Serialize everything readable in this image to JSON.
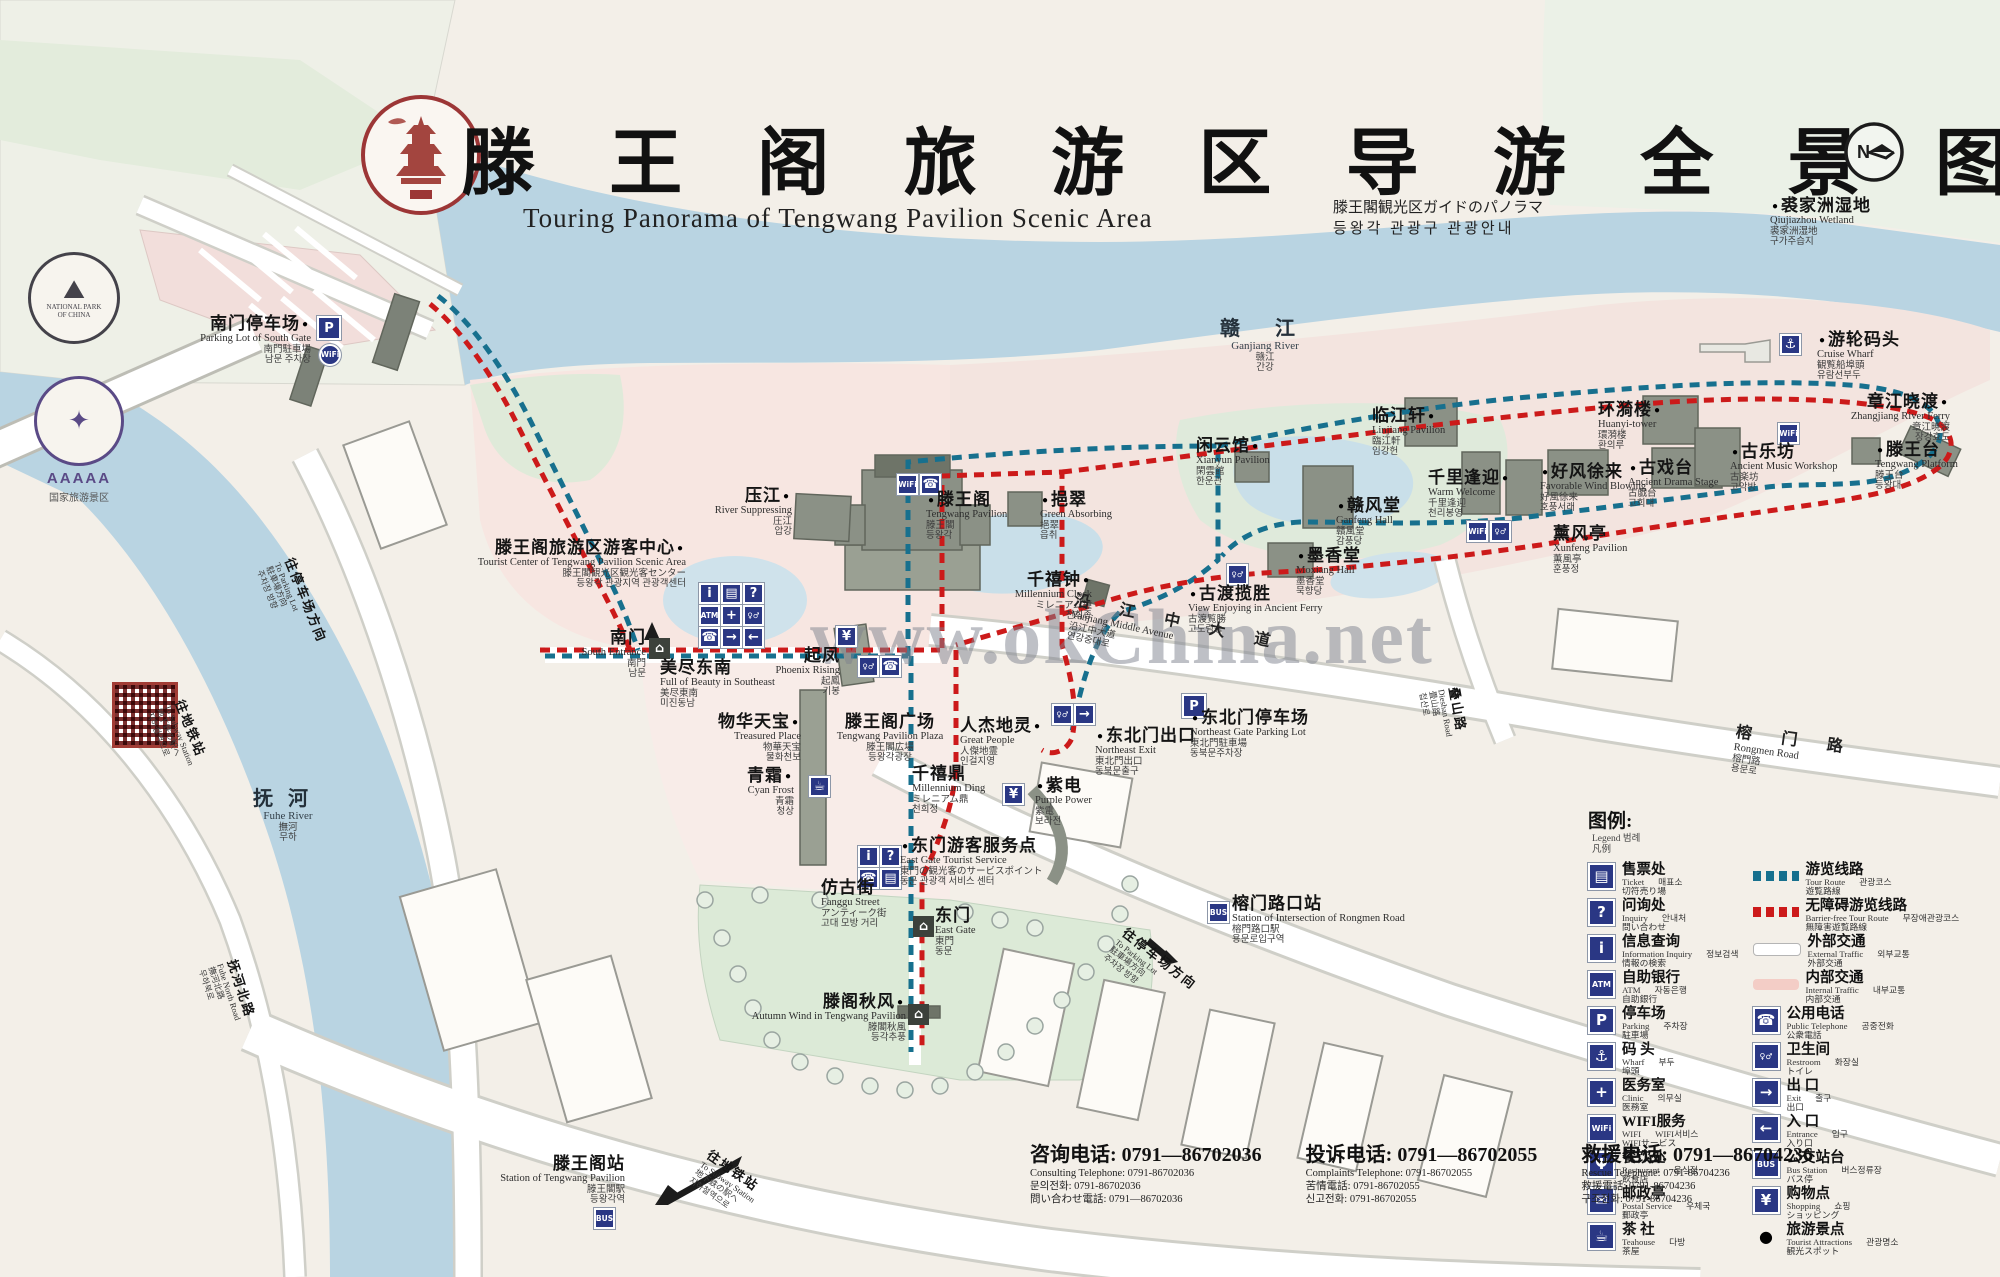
{
  "header": {
    "title": "滕 王 阁 旅 游 区 导 游 全 景 图",
    "subtitle_en": "Touring Panorama of Tengwang Pavilion Scenic Area",
    "subtitle_ja": "滕王閣観光区ガイドのパノラマ",
    "subtitle_ko": "등왕각 관광구 관광안내",
    "compass": "N",
    "seal_name": "tengwang-pavilion-seal"
  },
  "badges": {
    "national_park_line1": "NATIONAL PARK",
    "national_park_line2": "OF CHINA",
    "aaaaa": "AAAAA",
    "aaaaa_sub": "国家旅游景区"
  },
  "watermark": "www.okChina.net",
  "colors": {
    "tour_route": "#17708e",
    "barrier_free_route": "#cc1a1a",
    "icon_blue": "#2a3784",
    "water": "#b9d4e2",
    "park_green": "#dcead7",
    "garden_pink": "#f6e3de"
  },
  "map": {
    "labels": [
      {
        "id": "qiujiazhou-wetland",
        "zh": "裘家洲湿地",
        "en": "Qiujiazhou Wetland",
        "ja": "裘家洲湿地",
        "ko": "구가주습지",
        "x": 1770,
        "y": 196,
        "align": "l",
        "dot": "l"
      },
      {
        "id": "ganjiang-river",
        "zh": "赣 江",
        "en": "Ganjiang River",
        "ja": "赣江",
        "ko": "간강",
        "x": 1265,
        "y": 318,
        "align": "c",
        "cls": "river"
      },
      {
        "id": "cruise-wharf",
        "zh": "游轮码头",
        "en": "Cruise Wharf",
        "ja": "観覧船埠頭",
        "ko": "유람선부두",
        "x": 1817,
        "y": 330,
        "align": "l",
        "dot": "l"
      },
      {
        "id": "zhangjiang-river-ferry",
        "zh": "章江晓渡",
        "en": "Zhangjiang River Ferry",
        "ja": "章江暁渡",
        "ko": "장강효도",
        "x": 1950,
        "y": 392,
        "align": "r",
        "dot": "r"
      },
      {
        "id": "tengwang-platform",
        "zh": "滕王台",
        "en": "Tengwang Platform",
        "ja": "滕王台",
        "ko": "등왕대",
        "x": 1875,
        "y": 440,
        "align": "l",
        "dot": "l"
      },
      {
        "id": "huanyi-tower",
        "zh": "环漪楼",
        "en": "Huanyi-tower",
        "ja": "環漪楼",
        "ko": "환의루",
        "x": 1598,
        "y": 400,
        "align": "l",
        "dot": "r"
      },
      {
        "id": "ancient-music-workshop",
        "zh": "古乐坊",
        "en": "Ancient Music Workshop",
        "ja": "古楽坊",
        "ko": "고악방",
        "x": 1730,
        "y": 442,
        "align": "l",
        "dot": "l"
      },
      {
        "id": "ancient-drama-stage",
        "zh": "古戏台",
        "en": "Ancient Drama Stage",
        "ja": "古戯台",
        "ko": "고희대",
        "x": 1628,
        "y": 458,
        "align": "l",
        "dot": "l"
      },
      {
        "id": "xunfeng-pavilion",
        "zh": "薰风亭",
        "en": "Xunfeng Pavilion",
        "ja": "薫風亭",
        "ko": "훈풍정",
        "x": 1553,
        "y": 524,
        "align": "l"
      },
      {
        "id": "favorable-wind-blowing",
        "zh": "好风徐来",
        "en": "Favorable Wind Blowing",
        "ja": "好風徐来",
        "ko": "호풍서래",
        "x": 1540,
        "y": 462,
        "align": "l",
        "dot": "l"
      },
      {
        "id": "warm-welcome",
        "zh": "千里逢迎",
        "en": "Warm Welcome",
        "ja": "千里逢迎",
        "ko": "천리봉영",
        "x": 1428,
        "y": 468,
        "align": "l",
        "dot": "r"
      },
      {
        "id": "linjiang-pavilion",
        "zh": "临江轩",
        "en": "Linjiang Pavilion",
        "ja": "臨江軒",
        "ko": "임강헌",
        "x": 1372,
        "y": 406,
        "align": "l",
        "dot": "r"
      },
      {
        "id": "ganfeng-hall",
        "zh": "赣风堂",
        "en": "Ganfeng Hall",
        "ja": "贛風堂",
        "ko": "감풍당",
        "x": 1336,
        "y": 496,
        "align": "l",
        "dot": "l"
      },
      {
        "id": "moxiang-hall",
        "zh": "墨香堂",
        "en": "Moxiang Hall",
        "ja": "墨香堂",
        "ko": "묵향당",
        "x": 1296,
        "y": 546,
        "align": "l",
        "dot": "l"
      },
      {
        "id": "xianyun-pavilion",
        "zh": "闲云馆",
        "en": "Xianyun Pavilion",
        "ja": "閑雲館",
        "ko": "한운관",
        "x": 1196,
        "y": 436,
        "align": "l",
        "dot": "r"
      },
      {
        "id": "ancient-ferry-view",
        "zh": "古渡揽胜",
        "en": "View Enjoying in Ancient Ferry",
        "ja": "古渡覧勝",
        "ko": "고도람승",
        "x": 1188,
        "y": 584,
        "align": "l",
        "dot": "l"
      },
      {
        "id": "millennium-clock",
        "zh": "千禧钟",
        "en": "Millennium Clock",
        "ja": "ミレニアム鐘",
        "ko": "천희종",
        "x": 1092,
        "y": 570,
        "align": "r",
        "dot": "r"
      },
      {
        "id": "green-absorbing",
        "zh": "挹翠",
        "en": "Green Absorbing",
        "ja": "挹翠",
        "ko": "읍취",
        "x": 1040,
        "y": 490,
        "align": "l",
        "dot": "l"
      },
      {
        "id": "tengwang-pavilion",
        "zh": "滕王阁",
        "en": "Tengwang Pavilion",
        "ja": "滕王閣",
        "ko": "등왕각",
        "x": 926,
        "y": 490,
        "align": "l",
        "dot": "l"
      },
      {
        "id": "river-suppressing",
        "zh": "压江",
        "en": "River Suppressing",
        "ja": "圧江",
        "ko": "압강",
        "x": 792,
        "y": 486,
        "align": "r",
        "dot": "r"
      },
      {
        "id": "visitor-center",
        "zh": "滕王阁旅游区游客中心",
        "en": "Tourist Center of Tengwang Pavilion Scenic Area",
        "ja": "滕王閣観光区観光客センター",
        "ko": "등왕각 관광지역 관광객센터",
        "x": 686,
        "y": 538,
        "align": "r",
        "dot": "r"
      },
      {
        "id": "south-gate-parking",
        "zh": "南门停车场",
        "en": "Parking Lot of South Gate",
        "ja": "南門駐車場",
        "ko": "남문 주차장",
        "x": 311,
        "y": 314,
        "align": "r",
        "dot": "r"
      },
      {
        "id": "south-entrance",
        "zh": "南门",
        "en": "South Entrance",
        "ja": "南門",
        "ko": "남문",
        "x": 646,
        "y": 628,
        "align": "r"
      },
      {
        "id": "beauty-in-southeast",
        "zh": "美尽东南",
        "en": "Full of Beauty in Southeast",
        "ja": "美尽東南",
        "ko": "미진동남",
        "x": 660,
        "y": 658,
        "align": "l"
      },
      {
        "id": "phoenix-rising",
        "zh": "起凤",
        "en": "Phoenix Rising",
        "ja": "起鳳",
        "ko": "기봉",
        "x": 840,
        "y": 646,
        "align": "r"
      },
      {
        "id": "treasured-place",
        "zh": "物华天宝",
        "en": "Treasured Place",
        "ja": "物華天宝",
        "ko": "물화천보",
        "x": 801,
        "y": 712,
        "align": "r",
        "dot": "r"
      },
      {
        "id": "tengwang-pavilion-plaza",
        "zh": "滕王阁广场",
        "en": "Tengwang Pavilion Plaza",
        "ja": "滕王閣広場",
        "ko": "등왕각광장",
        "x": 890,
        "y": 712,
        "align": "c"
      },
      {
        "id": "cyan-frost",
        "zh": "青霜",
        "en": "Cyan Frost",
        "ja": "青霜",
        "ko": "청상",
        "x": 794,
        "y": 766,
        "align": "r",
        "dot": "r"
      },
      {
        "id": "millennium-ding",
        "zh": "千禧鼎",
        "en": "Millennium Ding",
        "ja": "ミレニアム鼎",
        "ko": "천희정",
        "x": 912,
        "y": 764,
        "align": "l"
      },
      {
        "id": "great-people",
        "zh": "人杰地灵",
        "en": "Great People",
        "ja": "人傑地霊",
        "ko": "인걸지영",
        "x": 960,
        "y": 716,
        "align": "l",
        "dot": "r"
      },
      {
        "id": "northeast-exit",
        "zh": "东北门出口",
        "en": "Northeast Exit",
        "ja": "東北門出口",
        "ko": "동북문출구",
        "x": 1095,
        "y": 726,
        "align": "l",
        "dot": "l"
      },
      {
        "id": "northeast-gate-parking",
        "zh": "东北门停车场",
        "en": "Northeast Gate Parking Lot",
        "ja": "東北門駐車場",
        "ko": "동북문주차장",
        "x": 1190,
        "y": 708,
        "align": "l",
        "dot": "l"
      },
      {
        "id": "purple-power",
        "zh": "紫电",
        "en": "Purple Power",
        "ja": "紫電",
        "ko": "보라전",
        "x": 1035,
        "y": 776,
        "align": "l",
        "dot": "l"
      },
      {
        "id": "east-gate-tourist-service",
        "zh": "东门游客服务点",
        "en": "East Gate Tourist Service",
        "ja": "東門の観光客のサービスポイント",
        "ko": "동문 관광객 서비스 센터",
        "x": 900,
        "y": 836,
        "align": "l",
        "dot": "l"
      },
      {
        "id": "fanggu-street",
        "zh": "仿古街",
        "en": "Fanggu Street",
        "ja": "アンティーク街",
        "ko": "고대 모방 거리",
        "x": 821,
        "y": 878,
        "align": "l"
      },
      {
        "id": "east-gate",
        "zh": "东门",
        "en": "East Gate",
        "ja": "東門",
        "ko": "동문",
        "x": 935,
        "y": 906,
        "align": "l"
      },
      {
        "id": "autumn-wind",
        "zh": "滕阁秋风",
        "en": "Autumn Wind in Tengwang Pavilion",
        "ja": "滕閣秋風",
        "ko": "등각추풍",
        "x": 906,
        "y": 992,
        "align": "r",
        "dot": "r"
      },
      {
        "id": "to-parking-right",
        "zh": "往停车场方向",
        "en": "To Parking Lot",
        "ja": "駐車場方向",
        "ko": "주차장 방향",
        "x": 1128,
        "y": 926,
        "align": "l",
        "rot": 38,
        "cls": "small"
      },
      {
        "id": "rongmen-crossing-station",
        "zh": "榕门路口站",
        "en": "Station of Intersection of Rongmen Road",
        "ja": "榕門路口駅",
        "ko": "용문로입구역",
        "x": 1232,
        "y": 894,
        "align": "l"
      },
      {
        "id": "tengwang-pavilion-station",
        "zh": "滕王阁站",
        "en": "Station of Tengwang Pavilion",
        "ja": "滕王閣駅",
        "ko": "등왕각역",
        "x": 625,
        "y": 1154,
        "align": "r"
      },
      {
        "id": "to-subway-bottom",
        "zh": "往地铁站",
        "en": "To Subway Station",
        "ja": "地下鉄の駅へ",
        "ko": "지하철역으로",
        "x": 712,
        "y": 1148,
        "align": "l",
        "rot": 35,
        "cls": "small"
      },
      {
        "id": "to-subway-left",
        "zh": "往地铁站",
        "en": "To Subway Station",
        "ja": "地下鉄の駅へ",
        "ko": "지하철역으로",
        "x": 185,
        "y": 698,
        "align": "l",
        "rot": 68,
        "cls": "small"
      },
      {
        "id": "to-parking-left",
        "zh": "往停车场方向",
        "en": "To Parking Lot",
        "ja": "駐車場方向",
        "ko": "주차장 방향",
        "x": 295,
        "y": 556,
        "align": "l",
        "rot": 68,
        "cls": "small"
      },
      {
        "id": "fuhe-river",
        "zh": "抚河",
        "en": "Fuhe River",
        "ja": "撫河",
        "ko": "무하",
        "x": 288,
        "y": 788,
        "align": "c",
        "cls": "river"
      },
      {
        "id": "fuhe-north-road",
        "zh": "抚河北路",
        "en": "Fuhe North Road",
        "ja": "撫河北路",
        "ko": "무하북로",
        "x": 238,
        "y": 958,
        "align": "l",
        "rot": 72,
        "cls": "small"
      },
      {
        "id": "dieshan-road",
        "zh": "叠山路",
        "en": "Dieshan Road",
        "ja": "畳山路",
        "ko": "첩산로",
        "x": 1460,
        "y": 686,
        "align": "l",
        "rot": 80,
        "cls": "small"
      },
      {
        "id": "rongmen-road",
        "zh": "榕 门 路",
        "en": "Rongmen Road",
        "ja": "榕門路",
        "ko": "용문로",
        "x": 1737,
        "y": 724,
        "align": "l",
        "rot": 8,
        "cls": "roadname"
      },
      {
        "id": "yanjiang-middle-avenue",
        "zh": "沿 江 中 大 道",
        "en": "Yanjiang Middle Avenue",
        "ja": "沿江中大道",
        "ko": "연강중대로",
        "x": 1076,
        "y": 592,
        "align": "l",
        "rot": 12,
        "cls": "roadname"
      }
    ],
    "icons": [
      {
        "n": "parking-icon",
        "g": "P",
        "x": 317,
        "y": 316,
        "s": 24
      },
      {
        "n": "wifi-icon",
        "g": "WiFi",
        "x": 319,
        "y": 344,
        "s": 22,
        "c": "circle tiny"
      },
      {
        "n": "info-icon",
        "g": "i",
        "x": 699,
        "y": 583
      },
      {
        "n": "ticket-icon",
        "g": "▤",
        "x": 721,
        "y": 583
      },
      {
        "n": "inquiry-icon",
        "g": "?",
        "x": 743,
        "y": 583
      },
      {
        "n": "atm-icon",
        "g": "ATM",
        "x": 699,
        "y": 605,
        "c": "tiny"
      },
      {
        "n": "clinic-icon",
        "g": "+",
        "x": 721,
        "y": 605
      },
      {
        "n": "restroom-icon",
        "g": "♀♂",
        "x": 743,
        "y": 605,
        "c": "tiny"
      },
      {
        "n": "phone-icon",
        "g": "☎",
        "x": 699,
        "y": 627
      },
      {
        "n": "exit-icon",
        "g": "→",
        "x": 721,
        "y": 627
      },
      {
        "n": "entrance-icon",
        "g": "←",
        "x": 743,
        "y": 627
      },
      {
        "n": "wifi-icon",
        "g": "WiFi",
        "x": 897,
        "y": 474,
        "c": "tiny"
      },
      {
        "n": "phone-icon",
        "g": "☎",
        "x": 920,
        "y": 474
      },
      {
        "n": "restroom-icon",
        "g": "♀♂",
        "x": 1227,
        "y": 564,
        "c": "tiny"
      },
      {
        "n": "wifi-icon",
        "g": "WiFi",
        "x": 1467,
        "y": 521,
        "c": "tiny"
      },
      {
        "n": "restroom-icon",
        "g": "♀♂",
        "x": 1490,
        "y": 521,
        "c": "tiny"
      },
      {
        "n": "wifi-icon",
        "g": "WiFi",
        "x": 1778,
        "y": 423,
        "c": "tiny"
      },
      {
        "n": "wharf-icon",
        "g": "⚓",
        "x": 1780,
        "y": 334
      },
      {
        "n": "restroom-icon",
        "g": "♀♂",
        "x": 1052,
        "y": 704,
        "c": "tiny"
      },
      {
        "n": "exit-icon",
        "g": "→",
        "x": 1074,
        "y": 704
      },
      {
        "n": "parking-icon",
        "g": "P",
        "x": 1182,
        "y": 694,
        "s": 24
      },
      {
        "n": "shopping-icon",
        "g": "¥",
        "x": 1003,
        "y": 784
      },
      {
        "n": "teahouse-icon",
        "g": "☕",
        "x": 809,
        "y": 776
      },
      {
        "n": "info-icon",
        "g": "i",
        "x": 858,
        "y": 846
      },
      {
        "n": "inquiry-icon",
        "g": "?",
        "x": 880,
        "y": 846
      },
      {
        "n": "phone-icon",
        "g": "☎",
        "x": 858,
        "y": 868
      },
      {
        "n": "ticket-icon",
        "g": "▤",
        "x": 880,
        "y": 868
      },
      {
        "n": "shopping-icon",
        "g": "¥",
        "x": 836,
        "y": 626
      },
      {
        "n": "restroom-icon",
        "g": "♀♂",
        "x": 858,
        "y": 656,
        "c": "tiny"
      },
      {
        "n": "phone-icon",
        "g": "☎",
        "x": 880,
        "y": 656
      },
      {
        "n": "bus-stop-icon",
        "g": "BUS",
        "x": 1208,
        "y": 902,
        "c": "tiny"
      },
      {
        "n": "bus-stop-icon",
        "g": "BUS",
        "x": 594,
        "y": 1208,
        "c": "tiny"
      },
      {
        "n": "south-gate-icon",
        "g": "⌂",
        "x": 649,
        "y": 638,
        "c": "dark"
      },
      {
        "n": "east-gate-icon",
        "g": "⌂",
        "x": 913,
        "y": 916,
        "c": "dark"
      },
      {
        "n": "pavilion-marker-icon",
        "g": "⌂",
        "x": 908,
        "y": 1004,
        "c": "dark"
      }
    ]
  },
  "legend": {
    "title_zh": "图例:",
    "title_en": "Legend",
    "title_ko": "범례",
    "title_ja": "凡例",
    "left": [
      {
        "icon": "ticket-icon",
        "g": "▤",
        "zh": "售票处",
        "en": "Ticket",
        "ko": "매표소",
        "ja": "切符売り場"
      },
      {
        "icon": "inquiry-icon",
        "g": "?",
        "zh": "问询处",
        "en": "Inquiry",
        "ko": "안내처",
        "ja": "問い合わせ"
      },
      {
        "icon": "information-icon",
        "g": "i",
        "zh": "信息查询",
        "en": "Information Inquiry",
        "ko": "정보검색",
        "ja": "情報の検索"
      },
      {
        "icon": "atm-icon",
        "g": "ATM",
        "tiny": true,
        "zh": "自助银行",
        "en": "ATM",
        "ko": "자동은행",
        "ja": "自助銀行"
      },
      {
        "icon": "parking-icon",
        "g": "P",
        "zh": "停车场",
        "en": "Parking",
        "ko": "주차장",
        "ja": "駐車場"
      },
      {
        "icon": "wharf-icon",
        "g": "⚓",
        "zh": "码 头",
        "en": "Wharf",
        "ko": "부두",
        "ja": "埠頭"
      },
      {
        "icon": "clinic-icon",
        "g": "+",
        "zh": "医务室",
        "en": "Clinic",
        "ko": "의무실",
        "ja": "医務室"
      },
      {
        "icon": "wifi-icon",
        "g": "WiFi",
        "tiny": true,
        "zh": "WIFI服务",
        "en": "WIFI",
        "ko": "WIFI서비스",
        "ja": "WIFIサービス"
      },
      {
        "icon": "restaurant-icon",
        "g": "Ψ",
        "zh": "餐饮处",
        "en": "Restaurant",
        "ko": "음식점",
        "ja": "飲食店"
      },
      {
        "icon": "postal-icon",
        "g": "✉",
        "zh": "邮政亭",
        "en": "Postal Service",
        "ko": "우체국",
        "ja": "郵政亭"
      },
      {
        "icon": "teahouse-icon",
        "g": "☕",
        "zh": "茶 社",
        "en": "Teahouse",
        "ko": "다방",
        "ja": "茶屋"
      }
    ],
    "right": [
      {
        "sw": "sw-blue",
        "zh": "游览线路",
        "en": "Tour Route",
        "ko": "관광코스",
        "ja": "遊覧路線"
      },
      {
        "sw": "sw-red",
        "zh": "无障碍游览线路",
        "en": "Barrier-free Tour Route",
        "ko": "무장애관광코스",
        "ja": "無障害遊覧路線"
      },
      {
        "sw": "sw-white",
        "zh": "外部交通",
        "en": "External Traffic",
        "ko": "외부교통",
        "ja": "外部交通"
      },
      {
        "sw": "sw-pink",
        "zh": "内部交通",
        "en": "Internal Traffic",
        "ko": "내부교통",
        "ja": "内部交通"
      },
      {
        "icon": "telephone-icon",
        "g": "☎",
        "zh": "公用电话",
        "en": "Public Telephone",
        "ko": "공중전화",
        "ja": "公衆電話"
      },
      {
        "icon": "restroom-icon",
        "g": "♀♂",
        "tiny": true,
        "zh": "卫生间",
        "en": "Restroom",
        "ko": "화장실",
        "ja": "トイレ"
      },
      {
        "icon": "exit-icon",
        "g": "→",
        "zh": "出 口",
        "en": "Exit",
        "ko": "출구",
        "ja": "出口"
      },
      {
        "icon": "entrance-icon",
        "g": "←",
        "zh": "入 口",
        "en": "Entrance",
        "ko": "입구",
        "ja": "入り口"
      },
      {
        "icon": "bus-icon",
        "g": "BUS",
        "tiny": true,
        "zh": "公交站台",
        "en": "Bus Station",
        "ko": "버스정류장",
        "ja": "バス停"
      },
      {
        "icon": "shopping-icon",
        "g": "¥",
        "zh": "购物点",
        "en": "Shopping",
        "ko": "쇼핑",
        "ja": "ショッピング"
      },
      {
        "icon": "attraction-dot-icon",
        "g": "●",
        "plain": true,
        "zh": "旅游景点",
        "en": "Tourist Attractions",
        "ko": "관광명소",
        "ja": "観光スポット"
      }
    ]
  },
  "contacts": [
    {
      "id": "consulting",
      "zh": "咨询电话: 0791—86702036",
      "lines": [
        "Consulting Telephone: 0791-86702036",
        "문의전화: 0791-86702036",
        "問い合わせ電話: 0791—86702036"
      ]
    },
    {
      "id": "complaints",
      "zh": "投诉电话: 0791—86702055",
      "lines": [
        "Complaints Telephone: 0791-86702055",
        "苦情電話: 0791-86702055",
        "신고전화: 0791-86702055"
      ]
    },
    {
      "id": "rescue",
      "zh": "救援电话: 0791—86704236",
      "lines": [
        "Rescue Telephone: 0791-86704236",
        "救援電話: 0791-86704236",
        "구조전화: 0791-86704236"
      ]
    }
  ]
}
